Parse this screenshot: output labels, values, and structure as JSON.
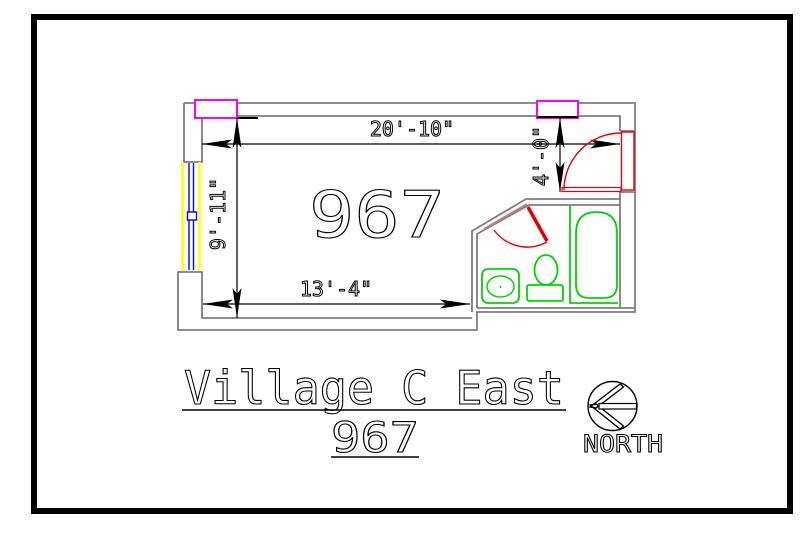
{
  "drawing": {
    "room_number": "967",
    "dimensions": {
      "top": "20'-10\"",
      "left": "9'-11\"",
      "bottom": "13'-4\"",
      "entry": "4'-0\""
    },
    "title": {
      "line1": "Village C East",
      "line2": "967"
    },
    "compass": {
      "label": "NORTH"
    },
    "colors": {
      "wall": "#7d7d7d",
      "dimension_line": "#000000",
      "door": "#e80000",
      "door_closed_leaf": "#c87f7f",
      "fixtures": "#00d400",
      "window_band": "#ffff00",
      "window_glazing": "#0000ff",
      "window_marker": "#ff00ff",
      "sheet_border": "#000000"
    }
  }
}
